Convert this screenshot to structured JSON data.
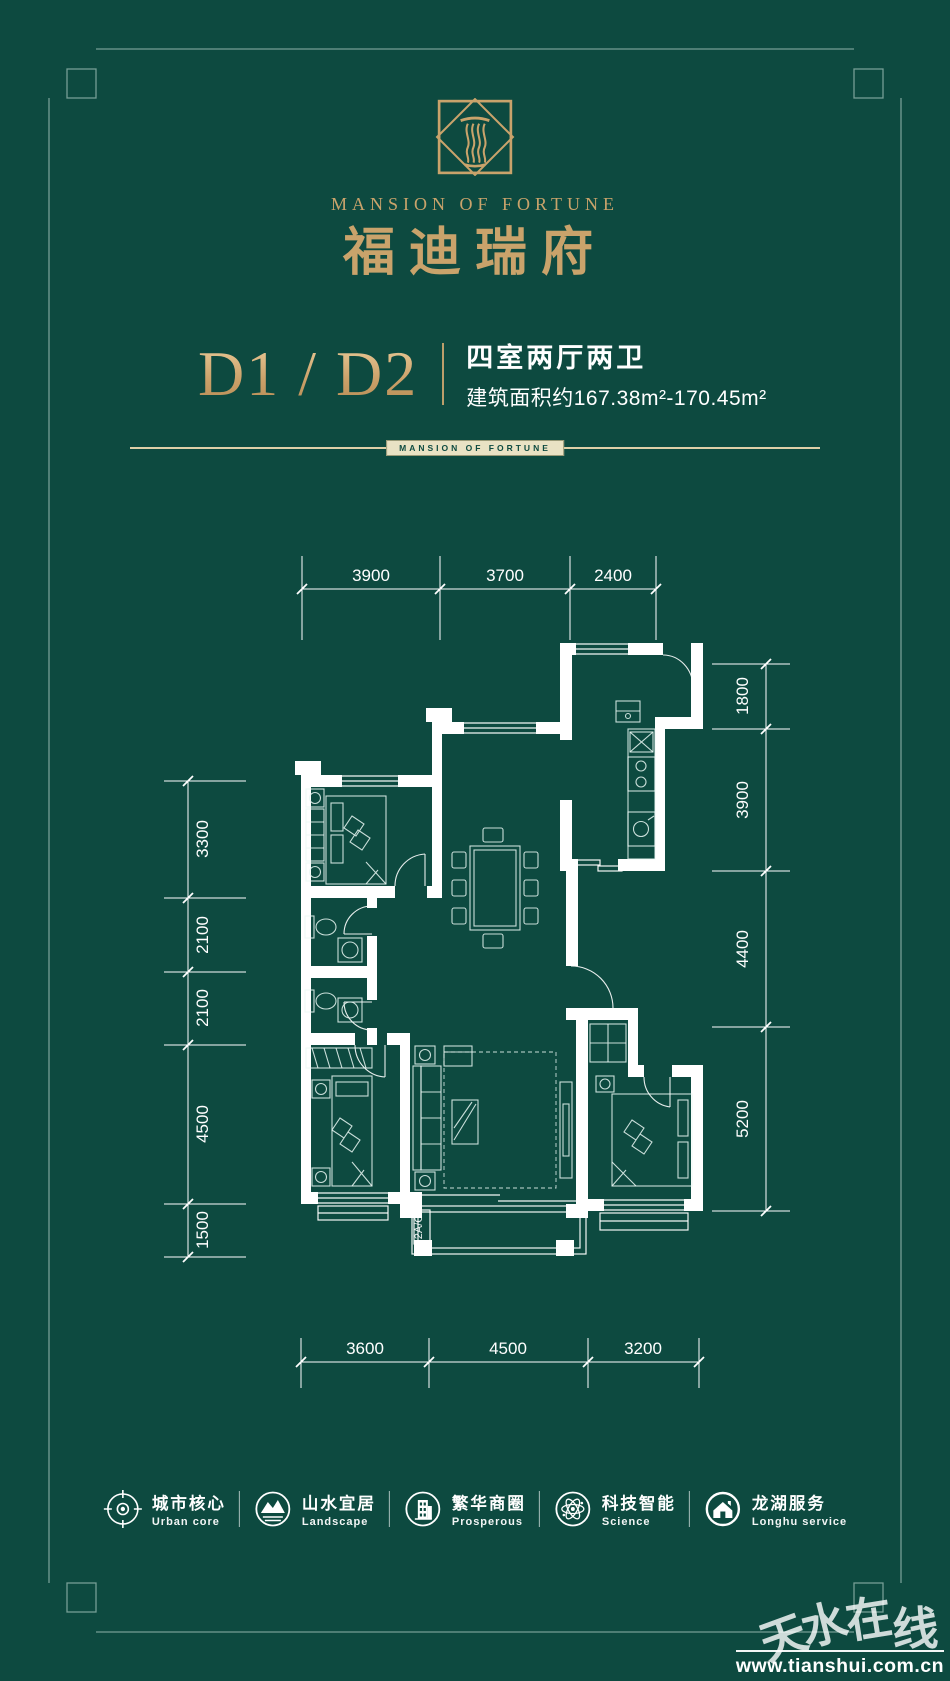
{
  "colors": {
    "background": "#0d4a40",
    "gold": "#c9a36b",
    "plan_line": "#ffffff",
    "frame_line": "#cde4da"
  },
  "header": {
    "brand_en": "MANSION OF FORTUNE",
    "brand_cn": "福迪瑞府"
  },
  "title": {
    "unit": "D1 / D2",
    "rooms": "四室两厅两卫",
    "area": "建筑面积约167.38m²-170.45m²",
    "divider_label": "MANSION OF FORTUNE"
  },
  "plan": {
    "dims_top": [
      "3900",
      "3700",
      "2400"
    ],
    "dims_right": [
      "1800",
      "3900",
      "4400",
      "5200"
    ],
    "dims_left": [
      "3300",
      "2100",
      "2100",
      "4500",
      "1500"
    ],
    "dims_bottom": [
      "3600",
      "4500",
      "3200"
    ],
    "balcony_label": "2A/C"
  },
  "features": [
    {
      "icon": "compass",
      "cn": "城市核心",
      "en": "Urban core"
    },
    {
      "icon": "mountain",
      "cn": "山水宜居",
      "en": "Landscape"
    },
    {
      "icon": "building",
      "cn": "繁华商圈",
      "en": "Prosperous"
    },
    {
      "icon": "atom",
      "cn": "科技智能",
      "en": "Science"
    },
    {
      "icon": "house",
      "cn": "龙湖服务",
      "en": "Longhu service"
    }
  ],
  "watermark": {
    "chars": [
      "天",
      "水",
      "在",
      "线"
    ],
    "url": "www.tianshui.com.cn"
  }
}
